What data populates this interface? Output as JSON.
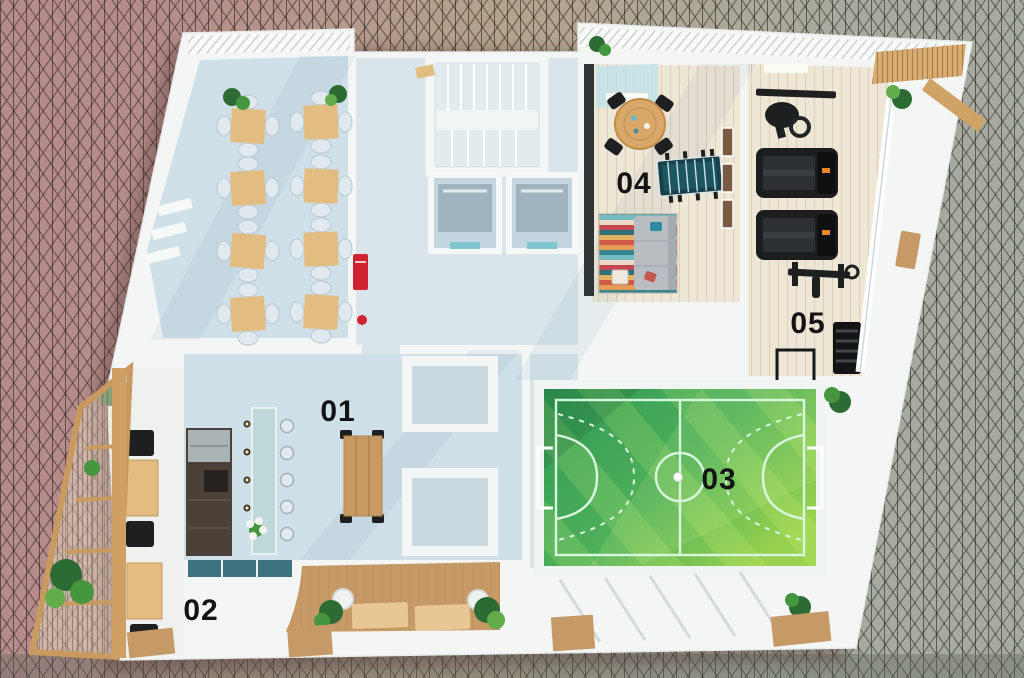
{
  "scene": {
    "description": "3D top-down floor plan render of a building amenities floor",
    "area_labels": {
      "a01": "01",
      "a02": "02",
      "a03": "03",
      "a04": "04",
      "a05": "05"
    }
  },
  "colors": {
    "bg-left": "#b58c8b",
    "bg-mid": "#b4a38d",
    "bg-right": "#a7ab9f",
    "shell-white": "#f3f6f5",
    "floor-blue": "#cfe0e9",
    "wood-floor": "#efe7d6",
    "field-green-dark": "#2e9854",
    "field-green-mid": "#4fb05a",
    "field-green-light": "#98d14f",
    "field-line": "#d9f7e0",
    "table-wood": "#e2bc80",
    "deck-wood": "#c69a66",
    "chair-black": "#1d1f20",
    "accent-red": "#cf2332",
    "label-black": "#131313"
  }
}
